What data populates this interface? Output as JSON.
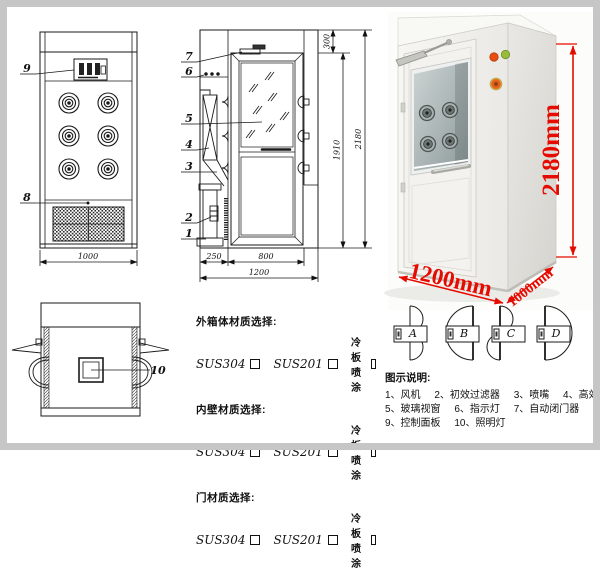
{
  "front_view": {
    "callout_9": "9",
    "callout_8": "8",
    "dim_width": "1000"
  },
  "side_view": {
    "callouts": [
      "7",
      "6",
      "5",
      "4",
      "3",
      "2",
      "1"
    ],
    "dim_250": "250",
    "dim_800": "800",
    "dim_1200": "1200",
    "dim_300": "300",
    "dim_1910": "1910",
    "dim_2180": "2180"
  },
  "top_view": {
    "callout_10": "10"
  },
  "photo": {
    "height": "2180mm",
    "width": "1200mm",
    "depth": "1000mm",
    "dim_color": "#e60b00"
  },
  "materials": {
    "sections": [
      {
        "title": "外箱体材质选择:",
        "options": [
          "SUS304",
          "SUS201",
          "冷板喷涂"
        ]
      },
      {
        "title": "内壁材质选择:",
        "options": [
          "SUS304",
          "SUS201",
          "冷板喷涂"
        ]
      },
      {
        "title": "门材质选择:",
        "options": [
          "SUS304",
          "SUS201",
          "冷板喷涂"
        ]
      }
    ]
  },
  "door_types": {
    "a": "A",
    "b": "B",
    "c": "C",
    "d": "D"
  },
  "legend": {
    "title": "图示说明:",
    "items": [
      "1、风机",
      "2、初效过滤器",
      "3、喷嘴",
      "4、高效过滤器",
      "5、玻璃视窗",
      "6、指示灯",
      "7、自动闭门器",
      "8、红外线感应器",
      "9、控制面板",
      "10、照明灯"
    ]
  }
}
